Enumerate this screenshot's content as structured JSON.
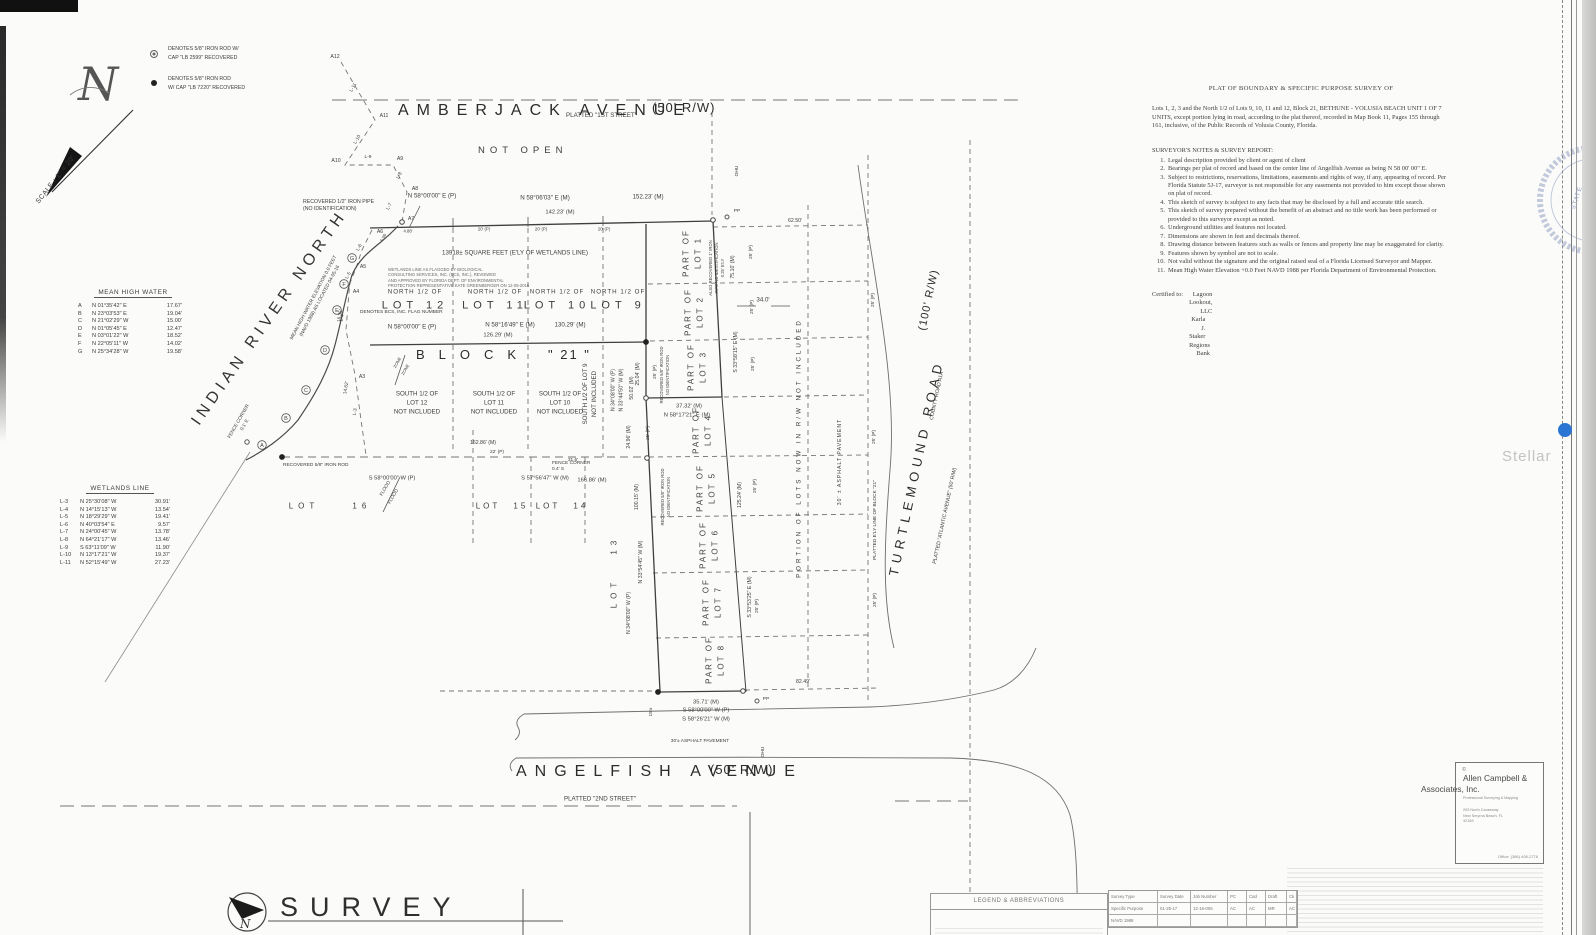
{
  "page": {
    "watermark": "Stellar",
    "seal_text": "STATE"
  },
  "scale_label": "SCALE : 1\" = 20'",
  "legend": {
    "item1_line1": "DENOTES 5/8\" IRON ROD W/",
    "item1_line2": "CAP \"LB 2599\" RECOVERED",
    "item2_line1": "DENOTES 5/8\" IRON ROD",
    "item2_line2": "W/ CAP \"LB 7220\" RECOVERED"
  },
  "points": {
    "a12": "A12",
    "a11": "A11",
    "a10": "A10",
    "a9": "A9",
    "a8": "A8",
    "a7": "A7",
    "a6": "A6",
    "a5": "A5",
    "a4": "A4",
    "a3": "A3",
    "l11": "L-11",
    "l10": "L-10",
    "l9": "L-9",
    "l8": "L-8",
    "l7": "L-7",
    "l6": "L-6",
    "l5": "L-5",
    "l4": "L-4",
    "l3": "L-3"
  },
  "streets": {
    "amberjack": {
      "name": "AMBERJACK AVENUE",
      "platted": "PLATTED \"1ST STREET\"",
      "rw": "(50' R/W)",
      "status": "NOT OPEN"
    },
    "angelfish": {
      "name": "ANGELFISH AVENUE",
      "rw": "(50' R/W)",
      "platted": "PLATTED \"2ND STREET\""
    },
    "turtlemound": {
      "name": "TURTLEMOUND ROAD",
      "rw": "(100' R/W)",
      "platted": "PLATTED \"ATLANTIC AVENUE\" (50' R/W)",
      "county": "COUNTY ROAD A1A"
    },
    "indian_river": "INDIAN RIVER NORTH"
  },
  "block": {
    "north_half": "NORTH 1/2 OF",
    "lot12": "LOT 12",
    "lot11": "LOT 11",
    "lot10": "LOT 10",
    "lot9": "LOT 9",
    "block_word": "BLOCK",
    "block_num": "\" 21 \"",
    "south_half": "SOUTH 1/2 OF",
    "not_included": "NOT INCLUDED",
    "south_lot12": "LOT 12",
    "south_lot11": "LOT 11",
    "south_lot10": "LOT 10",
    "south_lot9": "SOUTH 1/2 OF  LOT 9",
    "lot13": "LOT 13",
    "lot14": "LOT 14",
    "lot15": "LOT 15",
    "lot16": "LOT 16"
  },
  "parts": {
    "label": "PART OF",
    "lot1": "LOT 1",
    "lot2": "LOT 2",
    "lot3": "LOT 3",
    "lot4": "LOT 4",
    "lot5": "LOT 5",
    "lot6": "LOT 6",
    "lot7": "LOT 7",
    "lot8": "LOT 8"
  },
  "dims": {
    "top_bearing_p": "N 58°00'00\" E (P)",
    "top_bearing_m": "N 58°06'03\" E (M)",
    "top_dist_m": "152.23' (M)",
    "top_dist2_m": "142.23' (M)",
    "tick20": "20' (P)",
    "d488": "4.88'",
    "d509": "5.09",
    "d6250": "62.50'",
    "mid_bearing_p": "N 58°00'00\" E (P)",
    "mid_bearing_m": "N 58°16'49\" E (M)",
    "mid_dist_m": "130.29' (M)",
    "mid_dist2_m": "126.29' (M)",
    "sqft": "13918±  SQUARE FEET  (E'LY OF WETLANDS LINE)",
    "east1_dist": "75.10' (M)",
    "east1_bearing": "S 33°58'15\" E (M)",
    "d340": "34.0'",
    "lot3_dist": "37.32' (M)",
    "lot3_bearing": "N 58°17'21\" E (M)",
    "w2504": "25.04' (M)",
    "w2496": "24.96' (M)",
    "p25": "25' (P)",
    "w5002": "50.02' (M)",
    "west_p": "N 34°08'00\" W (P)",
    "west_m": "N 33°44'50\" W (M)",
    "west2_m": "N 33°54'45\" W (M)",
    "west2_p": "N 34°08'00\" W (P)",
    "w10015": "100.15' (M)",
    "east2_dist": "125.24' (M)",
    "east2_bearing": "S 33°53'25\" E (M)",
    "bot_dist1": "162.86' (M)",
    "d22p": "22' (P)",
    "bot_bearing_p": "S 58°00'00\" W (P)",
    "bot_bearing_m": "S 57°56'47\" W (M)",
    "bot_dist2": "166.86' (M)",
    "d315": "31.5'",
    "ang_dist": "35.71' (M)",
    "ang_p": "S 58°00'00\" W (P)",
    "ang_m": "S 58°26'21\" W (M)",
    "d8249": "82.49'",
    "d1462": "14.62'",
    "d1835": "18.35'",
    "d15": "15'±"
  },
  "annotations": {
    "rec_pipe1": "RECOVERED 1/2\" IRON PIPE",
    "rec_pipe2": "(NO IDENTIFICATION)",
    "rec_rod": "RECOVERED 5/8\" IRON ROD",
    "no_id": "NO IDENTIFICATION",
    "also_rec1": "ALSO RECOVERED 1\" IRON",
    "also_rec2": "PIPE NO IDENTIFICATION",
    "also_rec3": "0.25' E'LY",
    "wetnote1": "WETLANDS LINE AS FLAGGED BY BIOLOGICAL",
    "wetnote2": "CONSULTING SERVICES, INC. (BCS, INC.), REVIEWED",
    "wetnote3": "AND APPROVED BY FLORIDA DEPT. OF ENVIRONMENTAL",
    "wetnote4": "PROTECTION REPRESENTATIVE KATE GREENBERGER ON 12-05-2016",
    "flag_note": "DENOTES BCS, INC. FLAG NUMBER",
    "mhw_note1": "MEAN HIGH WATER ELEVATION 0.0 FEET",
    "mhw_note2": "(NAVD 1988) AS LOCATED 04-05-16",
    "fence1a": "FENCE CORNER",
    "fence1b": "0.1' E",
    "fence2a": "FENCE CORNER",
    "fence2b": "0.4' S",
    "flood": "FLOOD",
    "zone": "ZONE",
    "portion": "PORTION  OF  LOTS  NOW  IN  R/W  NOT  INCLUDED",
    "asphalt_v": "30' ±  ASPHALT  PAVEMENT",
    "asphalt_h": "30'±  ASPHALT  PAVEMENT",
    "platted_ely": "PLATTED E'LY LINE OF BLOCK \"21\"",
    "ohu": "OHU",
    "pp": "PP"
  },
  "mhw_table": {
    "title": "MEAN  HIGH  WATER",
    "rows": [
      [
        "A",
        "N 01°35'42\" E",
        "17.67'"
      ],
      [
        "B",
        "N 23°03'53\" E",
        "19.04'"
      ],
      [
        "C",
        "N 21°02'29\" W",
        "15.00'"
      ],
      [
        "D",
        "N 01°05'45\" E",
        "12.47'"
      ],
      [
        "E",
        "N 03°01'22\" W",
        "18.52'"
      ],
      [
        "F",
        "N 22°05'11\" W",
        "14.02'"
      ],
      [
        "G",
        "N 25°34'28\" W",
        "19.58'"
      ]
    ]
  },
  "wetlands_table": {
    "title": "WETLANDS LINE",
    "rows": [
      [
        "L-3",
        "N 25°30'08\" W",
        "30.91'"
      ],
      [
        "L-4",
        "N 14°15'13\" W",
        "13.54'"
      ],
      [
        "L-5",
        "N 18°29'29\" W",
        "19.41'"
      ],
      [
        "L-6",
        "N 40°03'54\" E",
        "9.57'"
      ],
      [
        "L-7",
        "N 24°00'45\" W",
        "13.78'"
      ],
      [
        "L-8",
        "N 64°21'17\" W",
        "13.46'"
      ],
      [
        "L-9",
        "S 63°11'09\" W",
        "11.90'"
      ],
      [
        "L-10",
        "N 13°17'21\" W",
        "19.37'"
      ],
      [
        "L-11",
        "N 52°15'49\" W",
        "27.23'"
      ]
    ]
  },
  "notes_panel": {
    "title": "PLAT OF BOUNDARY & SPECIFIC PURPOSE SURVEY OF",
    "legal": "Lots 1, 2, 3 and the North 1/2 of Lots 9, 10, 11 and 12, Block 21, BETHUNE - VOLUSIA  BEACH UNIT 1 OF 7 UNITS, except portion lying in road, according to the plat thereof, recorded in Map Book 11, Pages 155 through 161, inclusive, of the Public Records of Volusia County, Florida.",
    "heading": "SURVEYOR'S NOTES & SURVEY REPORT:",
    "items": [
      [
        "1.",
        "Legal description provided by client or agent of client"
      ],
      [
        "2.",
        "Bearings per plat of record and based on the center line of Angelfish Avenue as being N 58  00' 00\" E."
      ],
      [
        "3.",
        "Subject to restrictions, reservations, limitations, easements and rights of way, if any, appearing of record. Per Florida Statute 5J-17, surveyor is not responsible for any easements not provided to him except those shown on plat of record."
      ],
      [
        "4.",
        "This sketch of survey is subject to any facts that may be disclosed by a full and accurate title search."
      ],
      [
        "5.",
        "This sketch of survey prepared without the benefit of an abstract and no title work has been performed or provided to this surveyor except as noted."
      ],
      [
        "6.",
        "Underground utilities and features not located."
      ],
      [
        "7.",
        "Dimensions are shown in feet and decimals thereof."
      ],
      [
        "8.",
        "Drawing distance between features such as walls or fences and property line may be exaggerated for clarity."
      ],
      [
        "9.",
        "Features shown by symbol are not to scale."
      ],
      [
        "10.",
        "Not valid without the signature and the original raised seal of a Florida Licensed Surveyor and Mapper."
      ],
      [
        "11.",
        "Mean High Water Elevation +0.0 Feet NAVD 1988 per Florida Department of Environmental Protection."
      ]
    ],
    "certified_label": "Certified to:",
    "certified_names": [
      "Lagoon Lookout, LLC",
      "Karla J. Staker",
      "Regions Bank"
    ]
  },
  "firm": {
    "name1": "Allen Campbell &",
    "name2": "Associates, Inc.",
    "tagline": "Professional Surveying & Mapping",
    "addr1": "203 North Causeway",
    "addr2": "New Smyrna Beach, FL",
    "addr3": "32169",
    "phone": "Office:  (386) 408-2778",
    "copyright": "©"
  },
  "footer": {
    "survey": "SURVEY",
    "legend_title": "LEGEND & ABBREVIATIONS",
    "info_rows": [
      [
        "Survey Type",
        "Survey Date",
        "Job Number",
        "PC",
        "Cad",
        "Draft",
        "Ck"
      ],
      [
        "Specific Purpose",
        "01-25-17",
        "12-16-006",
        "AC",
        "AC",
        "MR",
        "AC"
      ],
      [
        "NAVD 1988",
        "",
        "",
        "",
        "",
        "",
        ""
      ]
    ]
  }
}
